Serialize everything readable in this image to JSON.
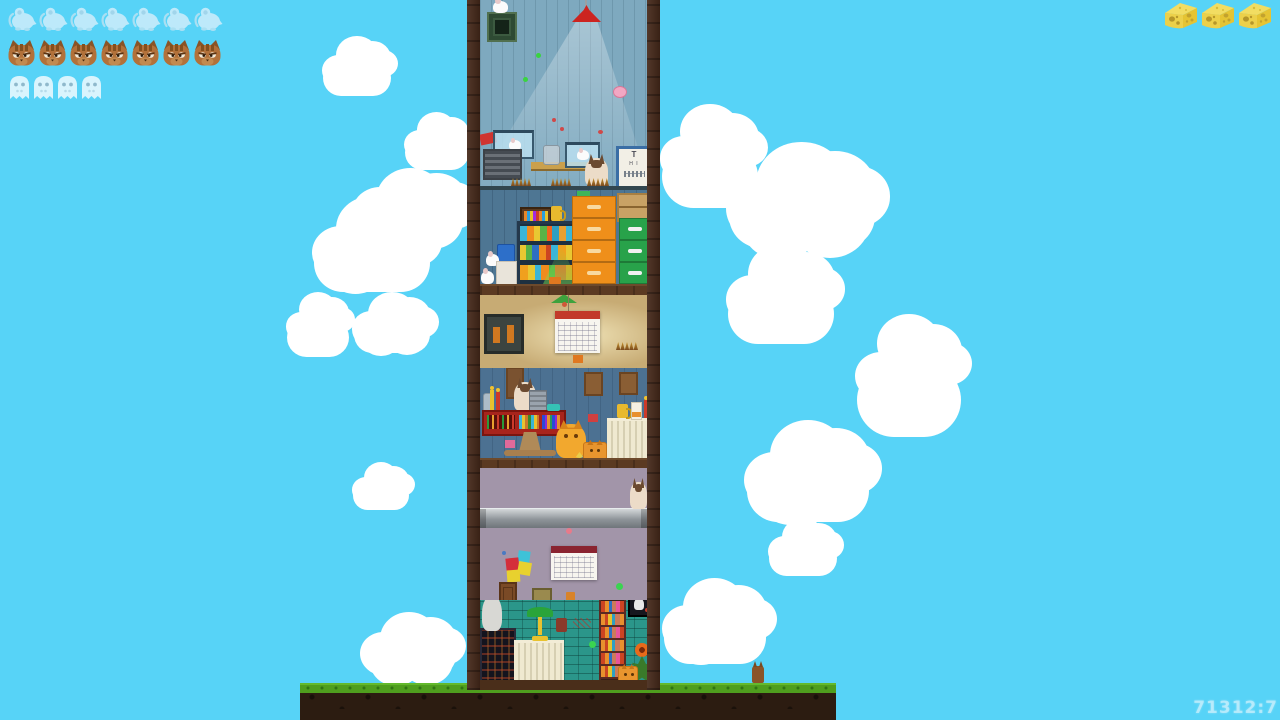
{
  "hud": {
    "mice": {
      "count": 7,
      "icon": "mouse-icon"
    },
    "cats": {
      "count": 7,
      "icon": "cat-icon"
    },
    "ghosts": {
      "count": 4,
      "icon": "ghost-icon"
    },
    "cheese": {
      "count": 3,
      "icon": "cheese-icon"
    },
    "score_text": "71312:7"
  },
  "eye_chart": {
    "rows": [
      "T",
      "H I"
    ]
  },
  "colors": {
    "sky": "#57d3f7",
    "cloud": "#ffffff",
    "wood_wall": "#46291a",
    "floor1_upper_wall": "#7ea9bf",
    "floor1_lower_wall": "#4e7693",
    "floor2_upper_wall": "#c7ab74",
    "floor2_lower_wall": "#4c7192",
    "floor3_upper_wall": "#a295a9",
    "floor3_lower_wall": "#2b968a",
    "grass": "#4f9e1e",
    "soil": "#2c1c11",
    "cheese_icon": "#e5c433",
    "cat_icon": "#b2713a",
    "mouse_icon": "#cfeefb",
    "ghost_icon": "#d9f4fd"
  },
  "background": {
    "clouds": [
      {
        "x": 322,
        "y": 36,
        "w": 70,
        "h": 62
      },
      {
        "x": 404,
        "y": 112,
        "w": 66,
        "h": 60
      },
      {
        "x": 352,
        "y": 168,
        "w": 118,
        "h": 64
      },
      {
        "x": 312,
        "y": 196,
        "w": 120,
        "h": 100
      },
      {
        "x": 286,
        "y": 292,
        "w": 64,
        "h": 68
      },
      {
        "x": 352,
        "y": 292,
        "w": 80,
        "h": 64
      },
      {
        "x": 352,
        "y": 462,
        "w": 58,
        "h": 50
      },
      {
        "x": 360,
        "y": 612,
        "w": 98,
        "h": 66
      },
      {
        "x": 660,
        "y": 104,
        "w": 100,
        "h": 108
      },
      {
        "x": 726,
        "y": 142,
        "w": 152,
        "h": 110
      },
      {
        "x": 726,
        "y": 244,
        "w": 110,
        "h": 104
      },
      {
        "x": 855,
        "y": 314,
        "w": 108,
        "h": 128
      },
      {
        "x": 744,
        "y": 420,
        "w": 128,
        "h": 106
      },
      {
        "x": 768,
        "y": 518,
        "w": 70,
        "h": 60
      },
      {
        "x": 662,
        "y": 578,
        "w": 106,
        "h": 90
      }
    ]
  },
  "scene": {
    "structure": "three-story tower interior on grassy ground",
    "rooms": [
      {
        "name": "attic-blue-room",
        "items": [
          "ceiling-lamp",
          "vent-grate",
          "white-mouse",
          "aquarium",
          "air-grille",
          "wall-shelf",
          "glass-jar",
          "aquarium",
          "siamese-cat",
          "eye-chart-poster",
          "caterpillars"
        ]
      },
      {
        "name": "blue-storage-room",
        "items": [
          "picture-frame",
          "mug",
          "bookshelf",
          "blue-box",
          "paper-bag",
          "white-mice",
          "orange-filing-cabinet",
          "cardboard-box",
          "green-filing-cabinet"
        ]
      },
      {
        "name": "tan-room",
        "items": [
          "green-hanging-lamp",
          "dark-painting",
          "wall-calendar",
          "caterpillars",
          "butterfly"
        ]
      },
      {
        "name": "blue-workshop-room",
        "items": [
          "hanging-boards",
          "siamese-cat",
          "cash-register",
          "red-display-counter",
          "pedestal-table",
          "orange-cat",
          "cat-face-box",
          "radiator",
          "mug",
          "juice-box",
          "candle"
        ]
      },
      {
        "name": "purple-room",
        "items": [
          "metal-pipe",
          "siamese-cat",
          "wall-calendar",
          "sticky-notes",
          "wooden-door",
          "crate"
        ]
      },
      {
        "name": "teal-brick-room",
        "items": [
          "dark-vending-machine",
          "gray-cat",
          "radiator",
          "bankers-lamp",
          "mug",
          "bookshelf",
          "cat-picture-frame",
          "flower-plant",
          "cat-face-box"
        ]
      }
    ]
  }
}
